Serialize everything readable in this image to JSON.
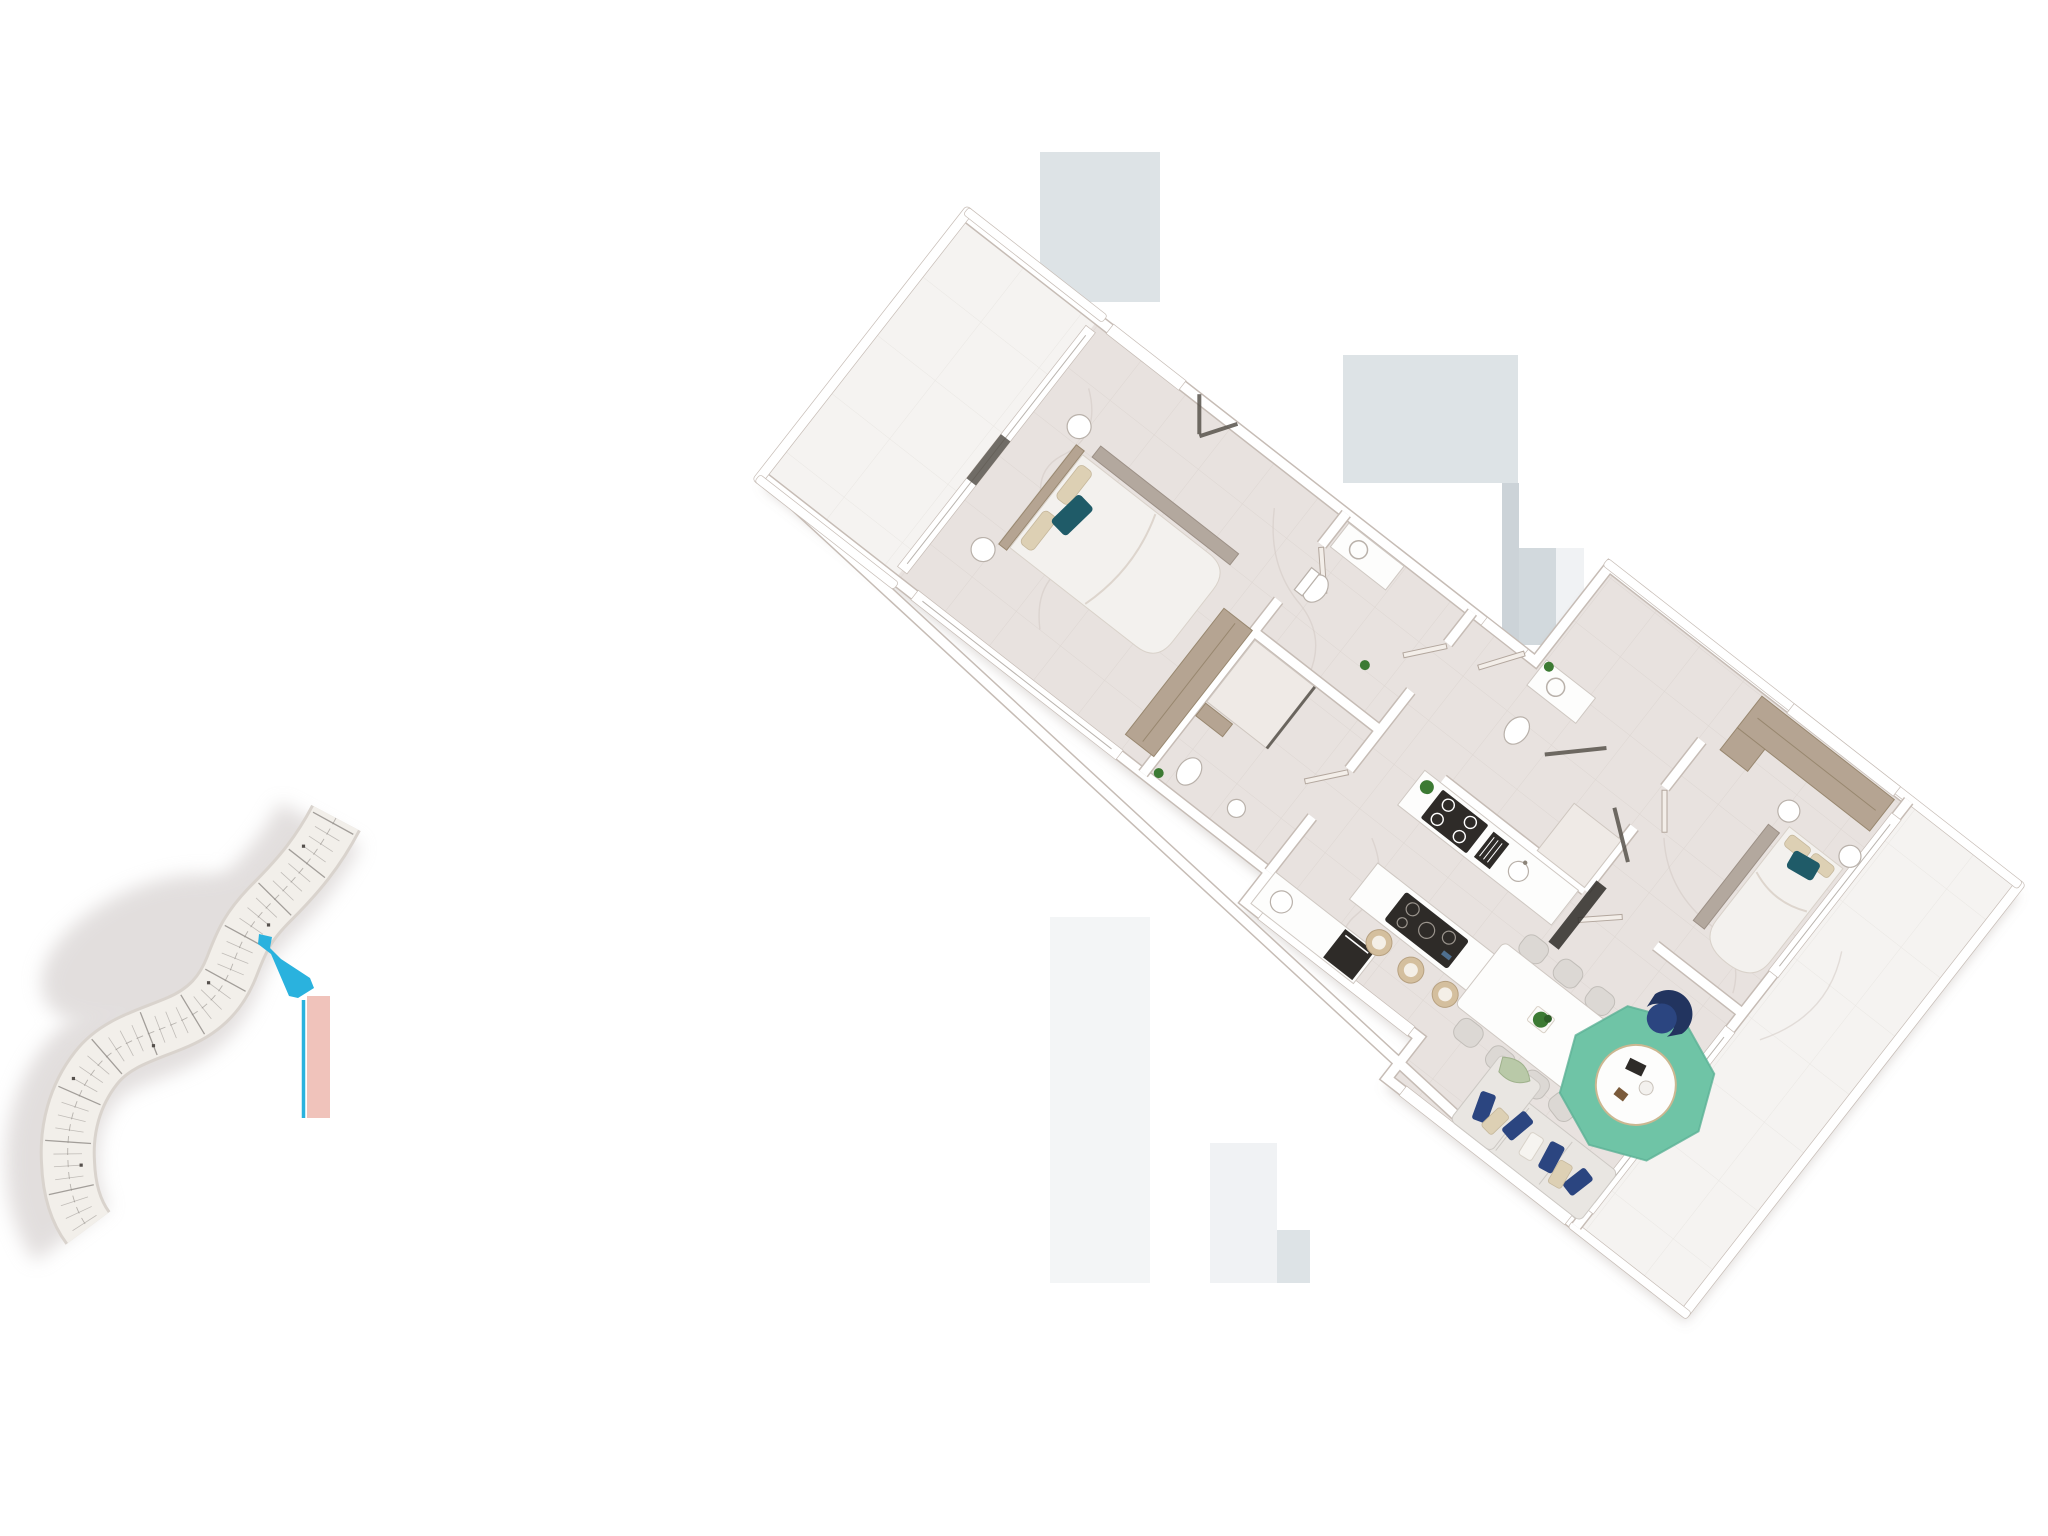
{
  "meta": {
    "title": "Residential unit 3D floor plan with building key plan",
    "canvas_width_px": 2048,
    "canvas_height_px": 1536,
    "visible_text": "none"
  },
  "palette": {
    "page_bg": "#ffffff",
    "floor": "#e8e2df",
    "floor_tile_line": "#d2c8c2",
    "terrace_floor": "#f5f3f1",
    "wall": "#ffffff",
    "wall_edge": "#c6bcb5",
    "wood": "#b5a492",
    "wood_dark": "#98876f",
    "duvet": "#f3f1ee",
    "linen_beige": "#ddd0b4",
    "pillow_teal": "#1f5b68",
    "navy": "#2b4580",
    "navy_dark": "#22345f",
    "rug_teal": "#6fc4a6",
    "sofa": "#e9e6e2",
    "stool_tan": "#d4bf9e",
    "plant_green": "#3c7a33",
    "appliance_dark": "#2e2b28",
    "glass_dark": "#57524b",
    "chair_gray": "#dcd8d4",
    "table_white": "#fdfdfc",
    "metal_gray": "#aaa29b",
    "ghost_blue": "#dde3e6",
    "ghost_blue_2": "#ccd3d8",
    "ghost_blue_3": "#d2d9dd",
    "ghost_faint": "#f0f2f4",
    "keyplan_paper": "#f2efea",
    "keyplan_edge": "#d9d3cd",
    "keyplan_line": "#8f8a86",
    "keyplan_shadow": "#cbc4c3",
    "highlight_cyan": "#2ab2de",
    "marker_pink": "#f0c3bb"
  },
  "key_plan": {
    "label": "building key plan – S-curved tower footprint",
    "highlighted_unit_color": "#2ab2de",
    "leader_line_color": "#2ab2de",
    "adjacent_marker_color": "#f0c3bb",
    "tick": {
      "spacing": 12,
      "half_length": 23
    },
    "highlighted_units": 1
  },
  "floor_plan": {
    "label": "apartment 3D top-view floor plan, rotated",
    "rotation_deg": 38,
    "rooms": [
      {
        "id": "terrace-main",
        "type": "terrace",
        "furniture": []
      },
      {
        "id": "bedroom-1",
        "type": "bedroom",
        "furniture": [
          "double-bed",
          "teal-accent-pillow",
          "beige-pillows",
          "side-bench",
          "nightstand",
          "nightstand",
          "wardrobe",
          "double-glass-door"
        ]
      },
      {
        "id": "bathroom-1",
        "type": "bathroom",
        "furniture": [
          "vanity-sink",
          "toilet"
        ]
      },
      {
        "id": "bathroom-2",
        "type": "bathroom",
        "furniture": [
          "walk-in-shower",
          "bench",
          "toilet",
          "sink",
          "plant"
        ]
      },
      {
        "id": "hallway",
        "type": "hall",
        "furniture": [
          "entry-door"
        ]
      },
      {
        "id": "kitchen",
        "type": "kitchen",
        "furniture": [
          "wall-counter",
          "cooktop-4-burner",
          "cutting-board",
          "round-sink",
          "oven",
          "lower-counter",
          "island",
          "induction-hob",
          "bar-stool",
          "bar-stool",
          "bar-stool",
          "plant"
        ]
      },
      {
        "id": "dining-area",
        "type": "dining",
        "furniture": [
          "dining-table",
          "chair",
          "chair",
          "chair",
          "chair",
          "chair",
          "chair",
          "chair",
          "plant-centerpiece"
        ]
      },
      {
        "id": "living-area",
        "type": "living",
        "furniture": [
          "octagonal-rug",
          "round-coffee-table",
          "navy-armchair",
          "sofa",
          "navy-cushions",
          "beige-cushions",
          "green-throw",
          "console"
        ]
      },
      {
        "id": "bathroom-3",
        "type": "bathroom",
        "furniture": [
          "vanity-sink",
          "toilet",
          "glass-shower",
          "plant"
        ]
      },
      {
        "id": "bedroom-2",
        "type": "bedroom",
        "furniture": [
          "double-bed",
          "teal-accent-pillow",
          "beige-pillows",
          "side-bench",
          "nightstand",
          "nightstand",
          "wardrobe"
        ]
      },
      {
        "id": "terrace-rear",
        "type": "terrace",
        "furniture": []
      }
    ]
  }
}
